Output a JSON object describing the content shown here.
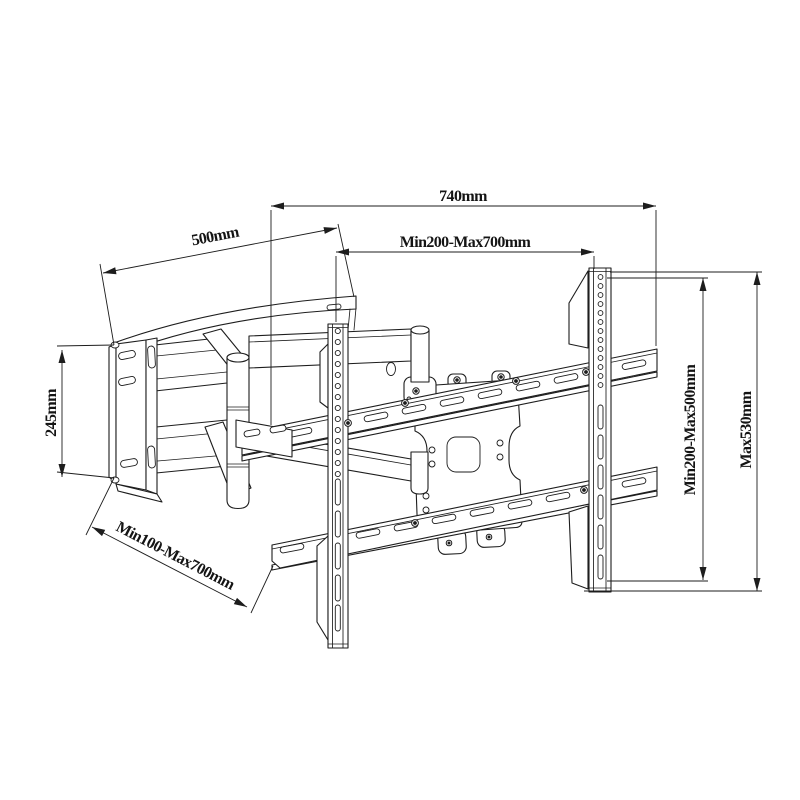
{
  "diagram": {
    "type": "technical-drawing",
    "colors": {
      "line": "#1d1d1d",
      "background": "#ffffff"
    },
    "dimensions": {
      "rail_width": "740mm",
      "mounting_width_range": "Min200-Max700mm",
      "arm_extension": "500mm",
      "wall_plate_height": "245mm",
      "lower_width_range": "Min100-Max700mm",
      "bracket_height_range": "Min200-Max500mm",
      "max_bracket_height": "Max530mm"
    }
  }
}
